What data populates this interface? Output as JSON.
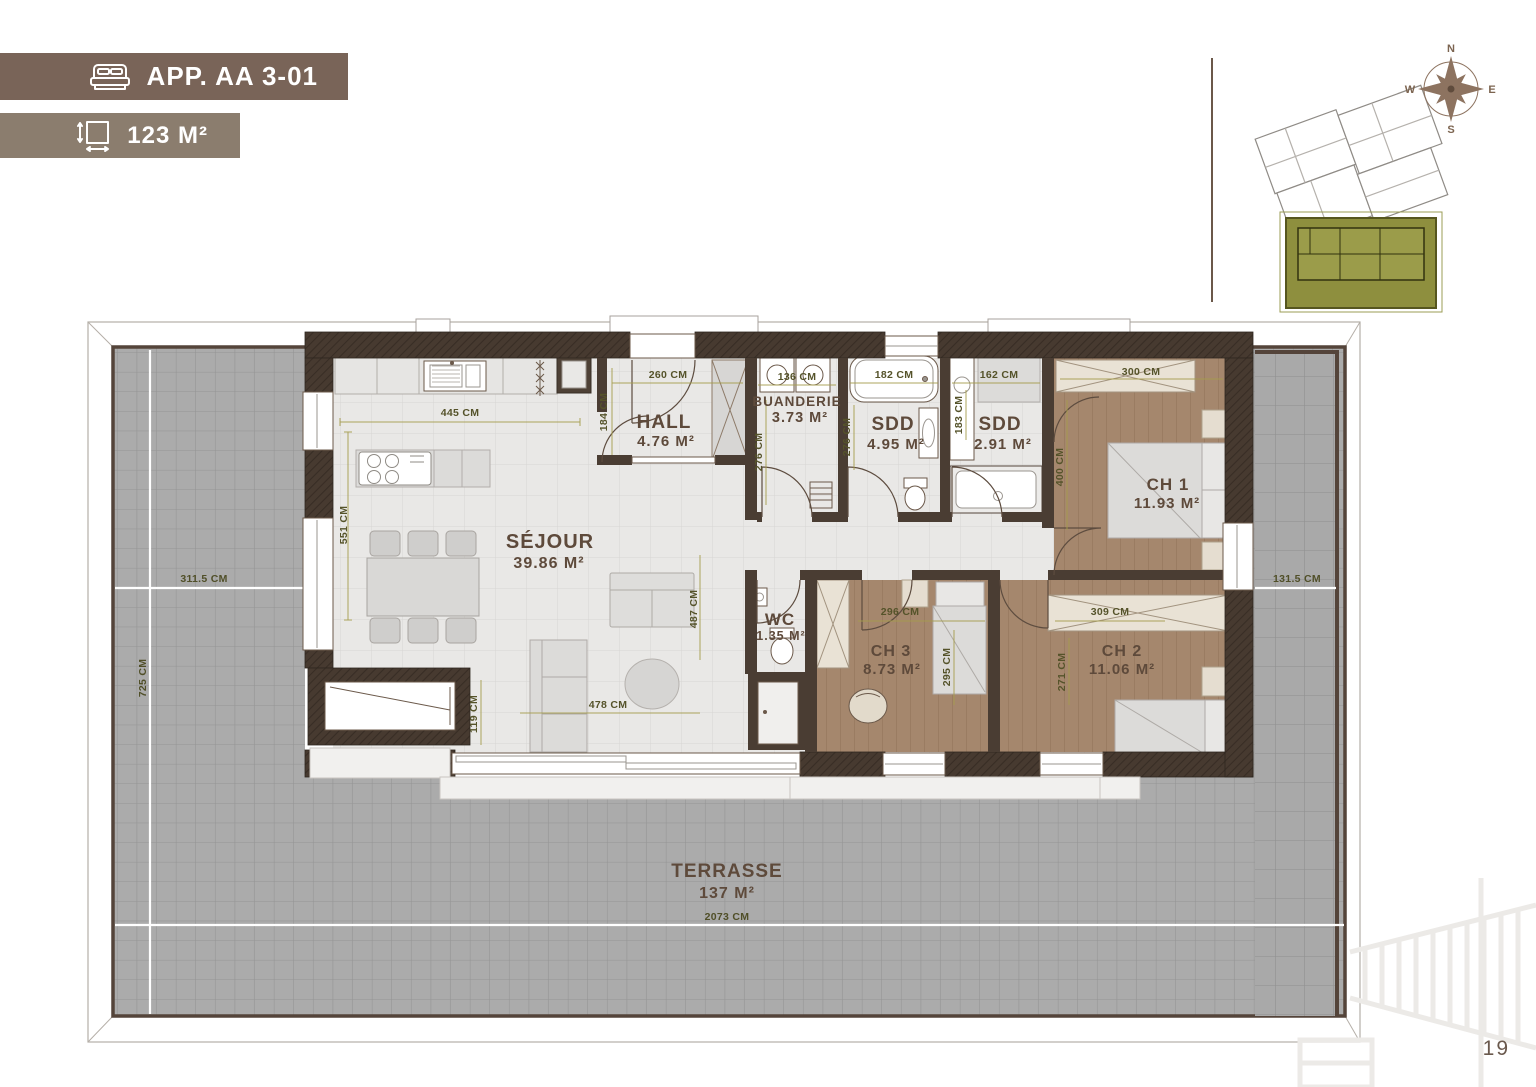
{
  "header": {
    "app_badge": {
      "label": "APP. AA 3-01",
      "icon": "bed-icon",
      "bg": "#796458"
    },
    "area_badge": {
      "label": "123 M²",
      "icon": "area-icon",
      "bg": "#8b7d6e"
    }
  },
  "minimap": {
    "compass": {
      "north": "N",
      "east": "E",
      "south": "S",
      "west": "W"
    },
    "highlight_color": "#8e8f3e"
  },
  "rooms": {
    "hall": {
      "name": "HALL",
      "area": "4.76 M²"
    },
    "buanderie": {
      "name": "BUANDERIE",
      "area": "3.73 M²"
    },
    "sdd_1": {
      "name": "SDD",
      "area": "4.95 M²"
    },
    "sdd_2": {
      "name": "SDD",
      "area": "2.91 M²"
    },
    "ch1": {
      "name": "CH 1",
      "area": "11.93 M²"
    },
    "sejour": {
      "name": "SÉJOUR",
      "area": "39.86 M²"
    },
    "wc": {
      "name": "WC",
      "area": "1.35 M²"
    },
    "ch3": {
      "name": "CH 3",
      "area": "8.73 M²"
    },
    "ch2": {
      "name": "CH 2",
      "area": "11.06 M²"
    },
    "terrasse": {
      "name": "TERRASSE",
      "area": "137 M²"
    }
  },
  "dimensions": {
    "kitchen_width": "445 CM",
    "kitchen_depth": "551 CM",
    "hall_width": "260 CM",
    "hall_depth": "184 CM",
    "buanderie_width": "136 CM",
    "buanderie_depth": "276 CM",
    "sdd1_width": "182 CM",
    "sdd1_depth": "276 CM",
    "sdd2_width": "162 CM",
    "sdd2_depth": "183 CM",
    "ch1_width": "300 CM",
    "ch1_depth": "400 CM",
    "sejour_width": "478 CM",
    "sejour_depth": "487 CM",
    "sejour_edge": "119 CM",
    "ch3_width": "296 CM",
    "ch3_depth": "295 CM",
    "ch2_width": "309 CM",
    "ch2_depth": "271 CM",
    "terrace_left_width": "311.5 CM",
    "terrace_left_height": "725 CM",
    "terrace_right_width": "131.5 CM",
    "terrace_bottom_width": "2073 CM"
  },
  "page": {
    "number": "19"
  },
  "colors": {
    "wall_brown": "#463a30",
    "wood_floor": "#a5876d",
    "terrace_tile": "#ababab",
    "dimension_olive": "#55532a",
    "room_label_brown": "#5e4a3b",
    "compass_brown": "#8d7360"
  }
}
